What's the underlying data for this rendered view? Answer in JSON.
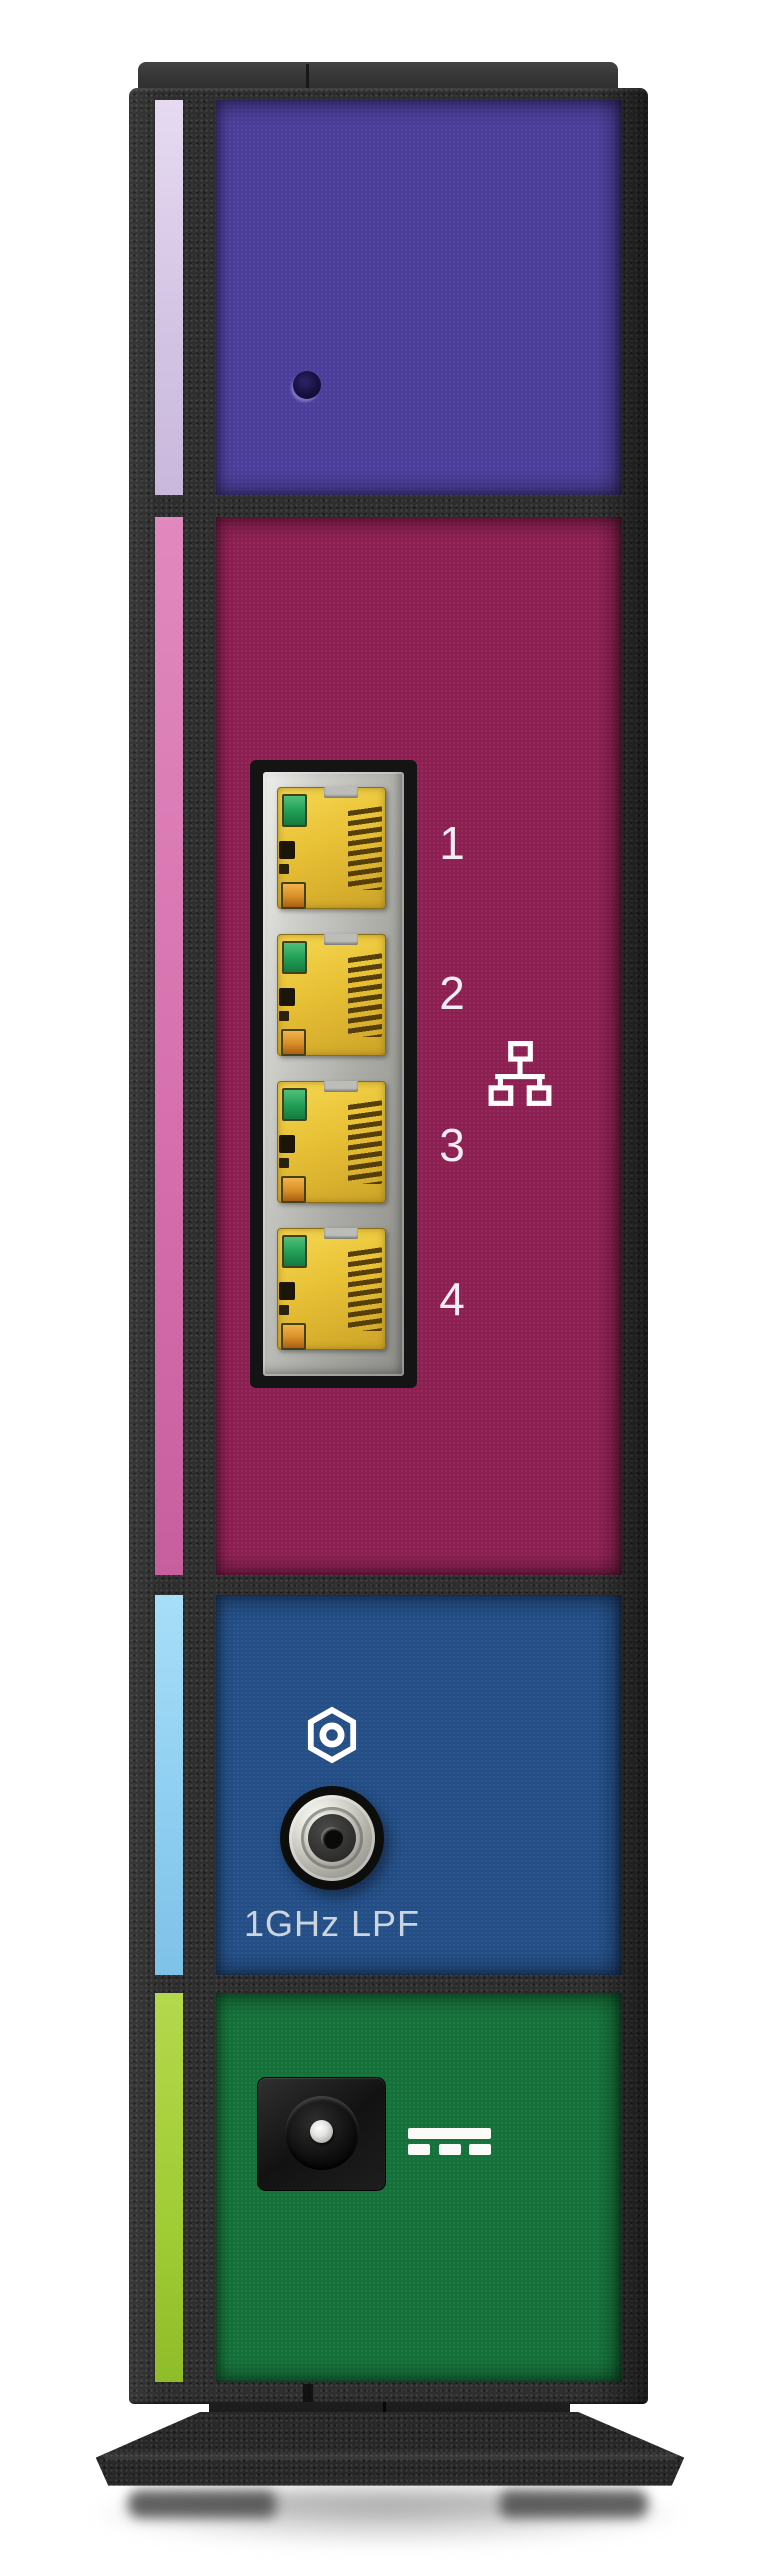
{
  "device_photo": {
    "description": "Rear panel of a vertical cable modem / router on a flared stand",
    "palette": {
      "chassis_frame": "#2d2e2d",
      "top_panel": "#4b3e9a",
      "top_accent_strip": "#d3c3e3",
      "ethernet_panel": "#8d2052",
      "ethernet_accent_strip": "#d671ad",
      "coax_panel": "#234e86",
      "coax_accent_strip": "#8ccdf0",
      "power_panel": "#15713a",
      "power_accent_strip": "#a0cc34",
      "jack_yellow": "#e8c136",
      "led_green": "#23a058",
      "led_amber": "#d88d27"
    },
    "ethernet": {
      "icon": "ethernet-network-icon",
      "port_labels": [
        "1",
        "2",
        "3",
        "4"
      ]
    },
    "coax": {
      "icon": "coax-connector-hex-icon",
      "label": "1GHz LPF"
    },
    "power": {
      "icon": "dc-power-icon"
    }
  }
}
